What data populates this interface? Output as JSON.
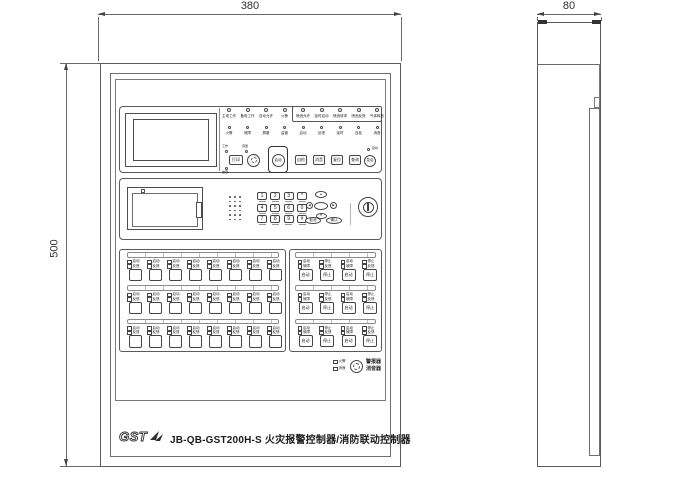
{
  "dimensions": {
    "width": "380",
    "height": "500",
    "depth": "80"
  },
  "branding": {
    "logo": "GST",
    "model_title": "JB-QB-GST200H-S 火灾报警控制器/消防联动控制器"
  },
  "top_panel": {
    "indicators_row1": [
      "主电工作",
      "备电工作",
      "自动允许",
      "火警"
    ],
    "indicators_row1_boxed": [
      "喷洒允许",
      "延时启动",
      "喷洒请求",
      "喷洒反馈",
      "气体释放"
    ],
    "indicators_row2": [
      "火警",
      "故障",
      "屏蔽",
      "监管",
      "启动",
      "反馈",
      "延时",
      "自检",
      "消音"
    ],
    "buttons": {
      "print": {
        "label": "打印",
        "led_top": "工作",
        "led_bottom": "故障"
      },
      "volume_knob_label": "音量",
      "protected_start": "启动",
      "row": [
        "自检",
        "消音",
        "复位",
        "查询"
      ],
      "round": {
        "label": "急启",
        "led": "延时"
      }
    }
  },
  "keypad": {
    "keys": [
      [
        "1",
        "2",
        "3",
        "*"
      ],
      [
        "4",
        "5",
        "6",
        "0"
      ],
      [
        "7",
        "8",
        "9",
        "#"
      ]
    ],
    "nav": {
      "up": "▲",
      "down": "▼",
      "left": "◀",
      "right": "▶",
      "center": ""
    },
    "actions": [
      "取消",
      "确认"
    ]
  },
  "zone_panel_left": {
    "rows": 3,
    "cols": 8,
    "led_line1": "启动",
    "led_line2": "反馈"
  },
  "zone_panel_right": {
    "rows": 3,
    "cells": [
      {
        "l1": "启动",
        "l2": "故障",
        "btn": "启动"
      },
      {
        "l1": "停止",
        "l2": "反馈",
        "btn": "停止"
      },
      {
        "l1": "启动",
        "l2": "故障",
        "btn": "启动"
      },
      {
        "l1": "停止",
        "l2": "反馈",
        "btn": "停止"
      }
    ]
  },
  "bottom_cluster": {
    "left_lines": [
      "火警",
      "消音"
    ],
    "right_lines": [
      "警报器",
      "消音器"
    ]
  }
}
